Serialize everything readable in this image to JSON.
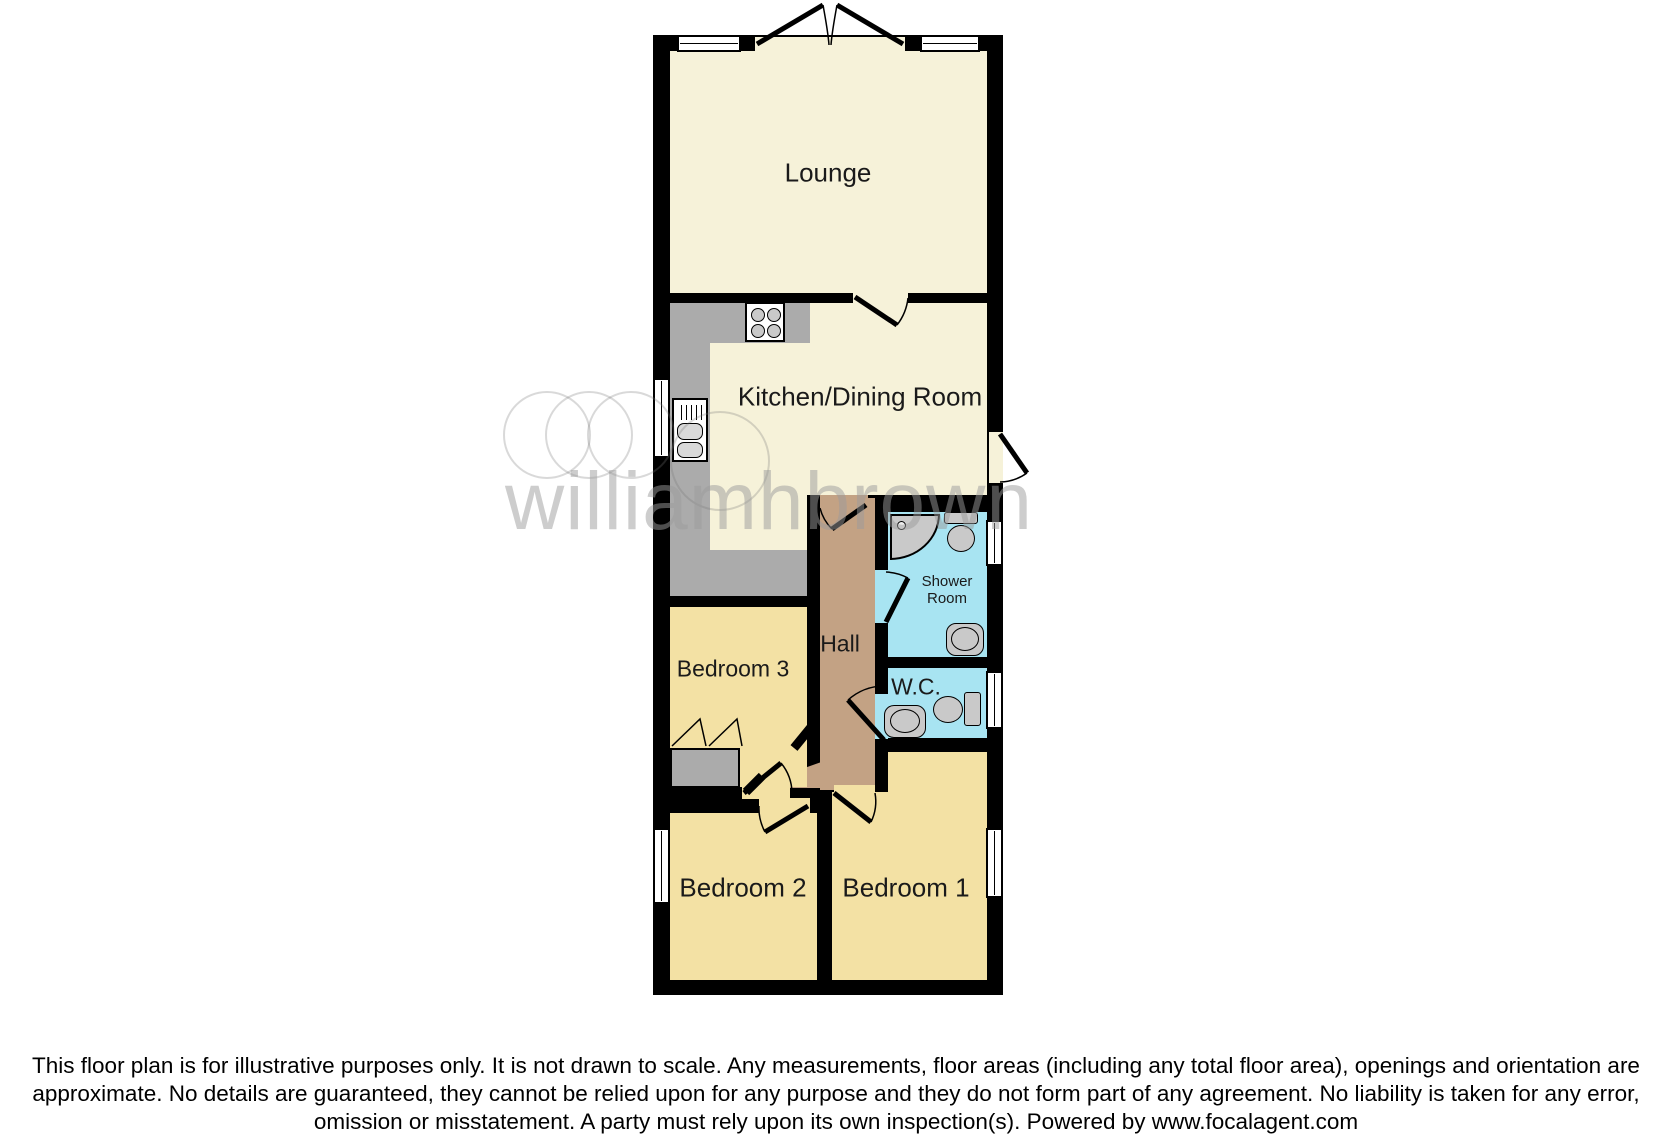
{
  "plan": {
    "rooms": {
      "lounge": "Lounge",
      "kitchen": "Kitchen/Dining Room",
      "shower_room": "Shower Room",
      "hall": "Hall",
      "bedroom3": "Bedroom 3",
      "wc": "W.C.",
      "bedroom2": "Bedroom 2",
      "bedroom1": "Bedroom 1"
    },
    "fixtures": [
      "hob",
      "kitchen-sink",
      "corner-shower",
      "toilet",
      "wash-basin",
      "wardrobe"
    ]
  },
  "watermark": {
    "text": "williamhbrown"
  },
  "footer": {
    "disclaimer": "This floor plan is for illustrative purposes only. It is not drawn to scale. Any measurements, floor areas (including any total floor area), openings and orientation are approximate. No details are guaranteed, they cannot be relied upon for any purpose and they do not form part of any agreement. No liability is taken for any error, omission or misstatement. A party must rely upon its own inspection(s). Powered by www.focalagent.com"
  },
  "colors": {
    "wall": "#000000",
    "room_day": "#f6f2d9",
    "bedroom": "#f3e1a4",
    "hall": "#c3a284",
    "wet_room": "#a8e4f2",
    "counter": "#ababab",
    "fixture": "#c9c9c9",
    "watermark": "#9c9c9c"
  }
}
